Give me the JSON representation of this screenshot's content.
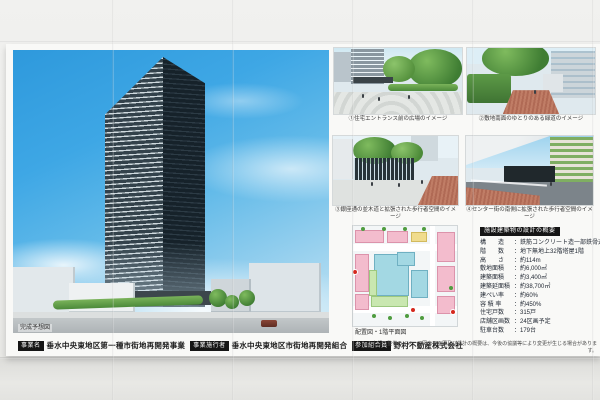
{
  "board": {
    "main_render": {
      "caption": "完成予想図"
    },
    "thumbnails": [
      {
        "caption": "①住宅エントランス前の広場のイメージ"
      },
      {
        "caption": "②敷地南面のゆとりのある緑道のイメージ"
      },
      {
        "caption": "③銀座通の並木道と拡張された歩行者空間のイメージ"
      },
      {
        "caption": "④センター街の南側に拡張された歩行者空間のイメージ"
      }
    ],
    "siteplan": {
      "caption": "配置図・1階平面図"
    },
    "spec": {
      "title": "施設建築物の設計の概要",
      "colon": "：",
      "rows": [
        {
          "label": "構　　造",
          "value": "鉄筋コンクリート造一部鉄骨造"
        },
        {
          "label": "階　　数",
          "value": "地下無地上32階塔屋1階"
        },
        {
          "label": "高　　さ",
          "value": "約114m"
        },
        {
          "label": "敷地面積",
          "value": "約6,000㎡"
        },
        {
          "label": "建築面積",
          "value": "約3,400㎡"
        },
        {
          "label": "建築延面積",
          "value": "約38,700㎡"
        },
        {
          "label": "建ぺい率",
          "value": "約60%"
        },
        {
          "label": "容 積 率",
          "value": "約450%"
        },
        {
          "label": "住宅戸数",
          "value": "315戸"
        },
        {
          "label": "店舗区画数",
          "value": "24区画予定"
        },
        {
          "label": "駐車台数",
          "value": "179台"
        }
      ]
    },
    "project_row": [
      {
        "badge": "事業名",
        "text": "垂水中央東地区第一種市街地再開発事業"
      },
      {
        "badge": "事業施行者",
        "text": "垂水中央東地区市街地再開発組合"
      },
      {
        "badge": "参加組合員",
        "text": "野村不動産株式会社"
      }
    ],
    "note": "※上記の整備のイメージ図や平面図及び設計の概要は、今後の協議等により変更が生じる場合があります。"
  },
  "colors": {
    "badge_bg": "#151515",
    "sky_blue": "#3ea7e5",
    "plan_pink": "#f3bccd",
    "plan_cyan": "#a3d8e3",
    "plan_green": "#c9e7b0",
    "wall": "#ececea"
  }
}
